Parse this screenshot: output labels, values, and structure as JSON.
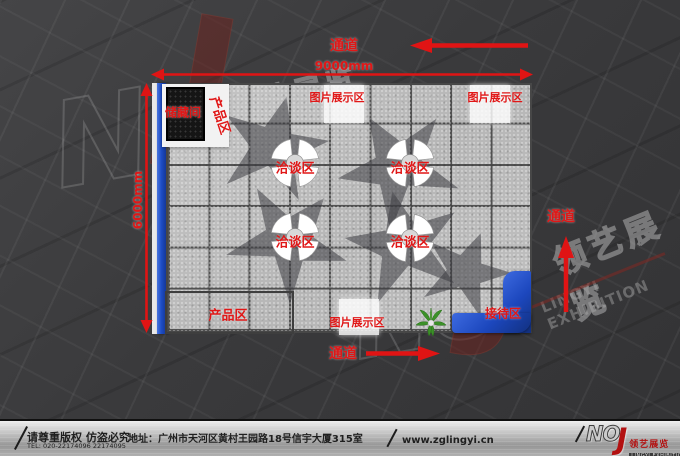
{
  "colors": {
    "accent_red": "#e01717",
    "wall_blue": "#1d4cc4",
    "floor_gray": "#bdbdbd",
    "background_dark": "#3a3a3c",
    "footer_metal": "#b5b5b5",
    "storage_black": "#151515"
  },
  "plan": {
    "width_label": "9000mm",
    "height_label": "6000mm",
    "aisle_top": "通道",
    "aisle_right": "通道",
    "aisle_bottom": "通道",
    "storage": "储藏间",
    "product_top": "产品区",
    "product_bottom": "产品区",
    "display_top_mid": "图片展示区",
    "display_top_right": "图片展示区",
    "display_bottom": "图片展示区",
    "negotiation": "洽谈区",
    "reception": "接待区"
  },
  "watermarks": {
    "letter_n": "N",
    "letter_o": "O",
    "letter_j": "J",
    "brand_cn": "领艺展览",
    "brand_en": "LINGYI EXHIBITION"
  },
  "footer": {
    "copyright": "请尊重版权 仿盗必究",
    "tel": "TEL: 020-22174096 22174095",
    "address": "地址：广州市天河区黄村王园路18号信宇大厦315室",
    "website": "www.zglingyi.cn",
    "logo_no": "NO",
    "logo_j": "J",
    "logo_cn": "领艺展览",
    "logo_en": "LINGYI EXHIBITION"
  }
}
